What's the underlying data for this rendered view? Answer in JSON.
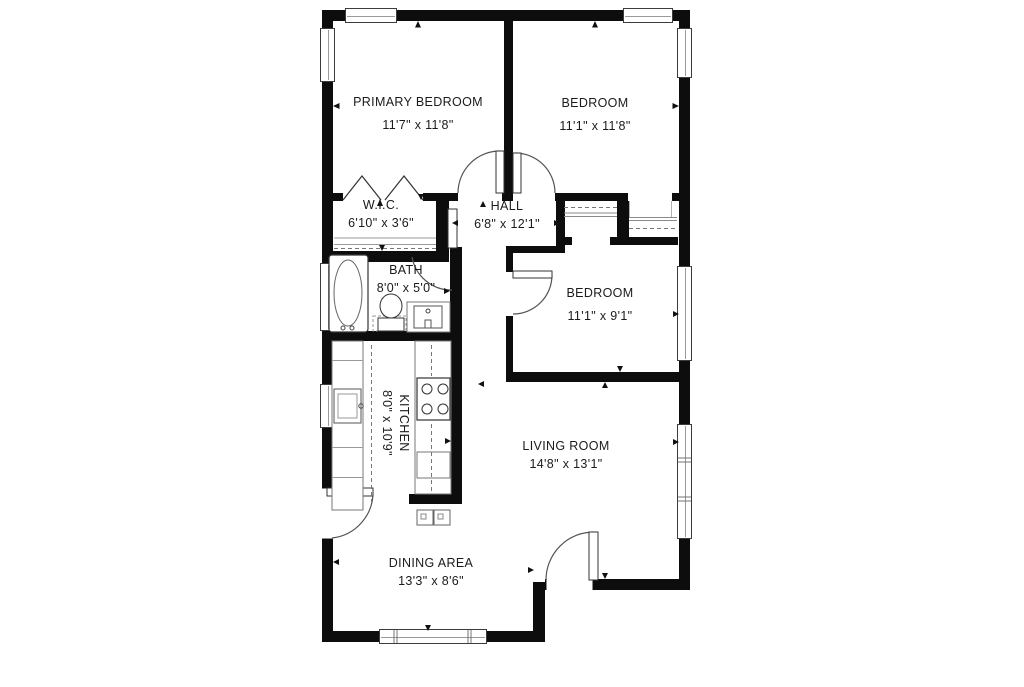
{
  "plan": {
    "title": "apartment-floor-plan",
    "rooms": [
      {
        "name": "PRIMARY BEDROOM",
        "dims": "11'7\" x 11'8\""
      },
      {
        "name": "BEDROOM",
        "dims": "11'1\" x 11'8\""
      },
      {
        "name": "W.I.C.",
        "dims": "6'10\" x 3'6\""
      },
      {
        "name": "HALL",
        "dims": "6'8\" x 12'1\""
      },
      {
        "name": "BATH",
        "dims": "8'0\" x 5'0\""
      },
      {
        "name": "BEDROOM",
        "dims": "11'1\" x 9'1\""
      },
      {
        "name": "KITCHEN",
        "dims": "8'0\" x 10'9\""
      },
      {
        "name": "LIVING ROOM",
        "dims": "14'8\" x 13'1\""
      },
      {
        "name": "DINING AREA",
        "dims": "13'3\" x 8'6\""
      }
    ],
    "colors": {
      "wall": "#0d0d0d",
      "line": "#555555",
      "text": "#1b1b1b",
      "background": "#ffffff"
    }
  }
}
